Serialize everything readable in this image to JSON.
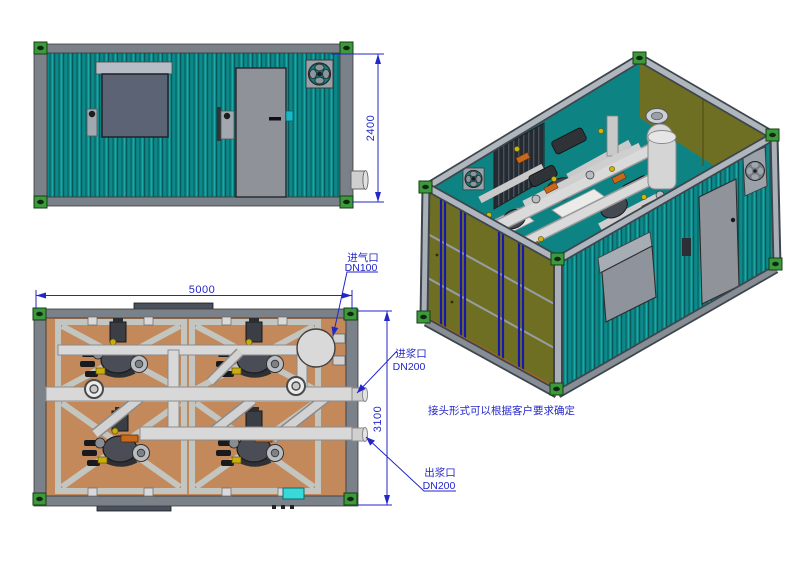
{
  "views": {
    "elevation": {
      "dim_height": "2400"
    },
    "plan": {
      "dim_length": "5000",
      "dim_width": "3100",
      "air_inlet": {
        "label": "进气口",
        "size": "DN100"
      },
      "slurry_inlet": {
        "label": "进浆口",
        "size": "DN200"
      },
      "slurry_outlet": {
        "label": "出浆口",
        "size": "DN200"
      }
    },
    "isometric": {
      "note": "接头形式可以根据客户要求确定"
    }
  },
  "colors": {
    "wall_teal": "#0e8888",
    "wall_olive": "#6f6f24",
    "floor_tan": "#c4895b",
    "frame_gray": "#7b8189",
    "corner_casting_green": "#3c9a3c",
    "annotation_blue": "#2326c9",
    "pipe_gray": "#d8d8d8",
    "cyan_box": "#38d9d9"
  }
}
